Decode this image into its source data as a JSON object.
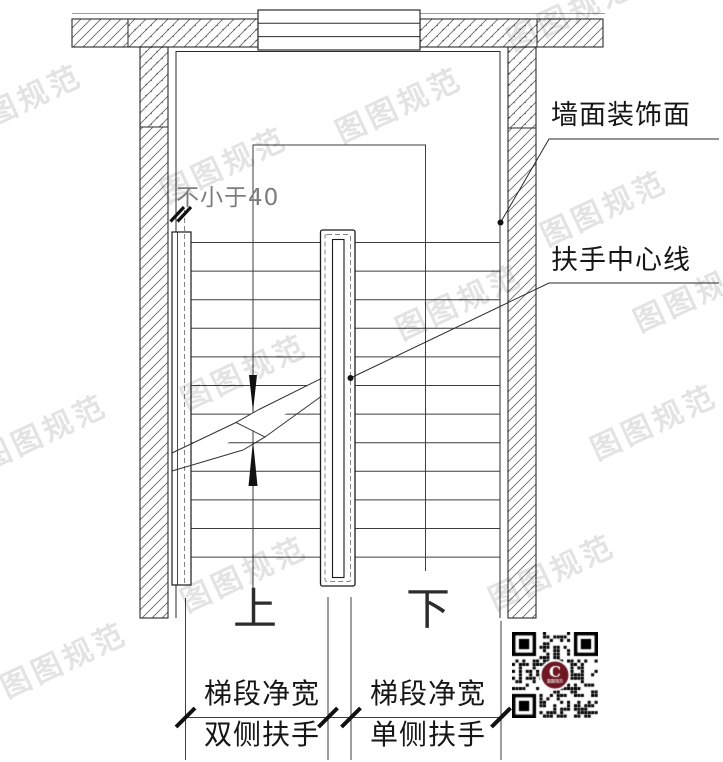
{
  "watermark": {
    "text": "图图规范"
  },
  "callouts": {
    "wall_finish": "墙面装饰面",
    "handrail_centerline": "扶手中心线",
    "min_clearance": "不小于40"
  },
  "direction_labels": {
    "up": "上",
    "down": "下"
  },
  "dimension_labels": {
    "left_top": "梯段净宽",
    "left_bottom": "双侧扶手",
    "right_top": "梯段净宽",
    "right_bottom": "单侧扶手"
  },
  "qr": {
    "logo_letter": "C",
    "logo_color": "#6e1722",
    "logo_caption": "图图规范"
  },
  "colors": {
    "line": "#2a2a2a",
    "thin_line": "#3d3d3d",
    "hatch": "#6a6a6a",
    "watermark": "rgba(0,0,0,0.11)",
    "gray_text": "#7d7d7d"
  }
}
